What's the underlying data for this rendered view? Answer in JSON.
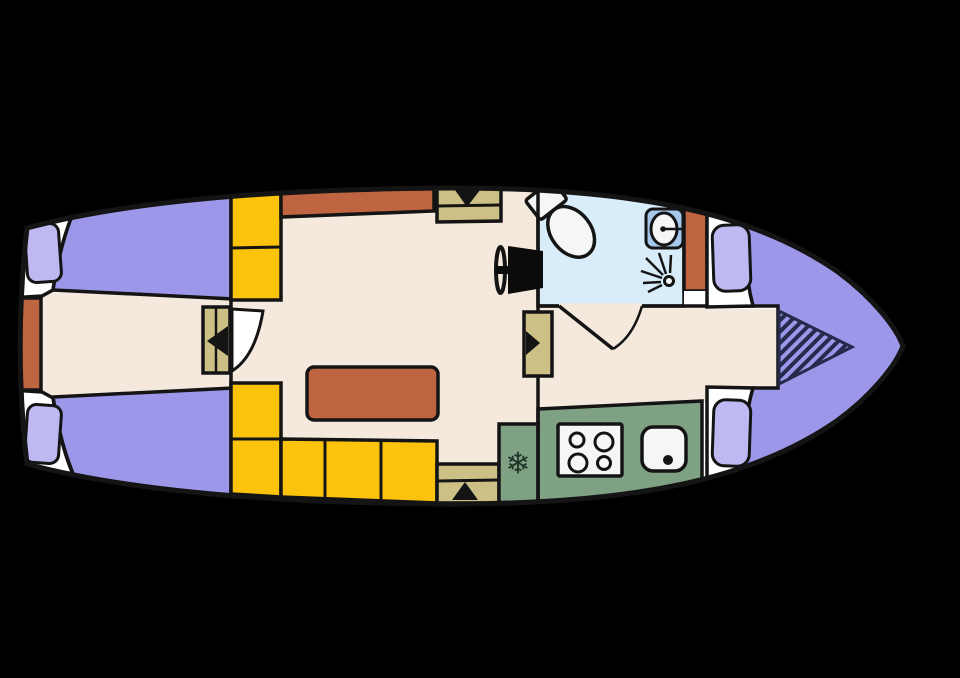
{
  "figure": {
    "name": "motor-yacht-deck-plan-top-view-bow-right"
  },
  "colors": {
    "background": "#000000",
    "outline": "#141414",
    "deck": "#ffffff",
    "floor": "#f4e9dc",
    "bed": "#9d97e9",
    "pillow": "#bfb9f2",
    "bench": "#fcc30d",
    "terracotta": "#bf6440",
    "bathroom": "#d8edf9",
    "kitchen": "#7fa184",
    "wood": "#cdc086",
    "sink_cabinet": "#a5c8eb",
    "fixture": "#f4f7f5",
    "helm": "#0b0b0b",
    "hatch_base": "#9d97e9",
    "hatch_line": "#262a4d",
    "snowflake": "#1d3326"
  },
  "icons": {
    "snowflake_glyph": "❄"
  },
  "areas": {
    "aft_cabin": "aft-cabin-two-single-berths",
    "salon": "salon-l-benches-table-helm",
    "bathroom": "bathroom-toilet-basin-shower",
    "galley": "galley-fridge-hob-sink",
    "bow_cabin": "bow-cabin-v-berth"
  }
}
